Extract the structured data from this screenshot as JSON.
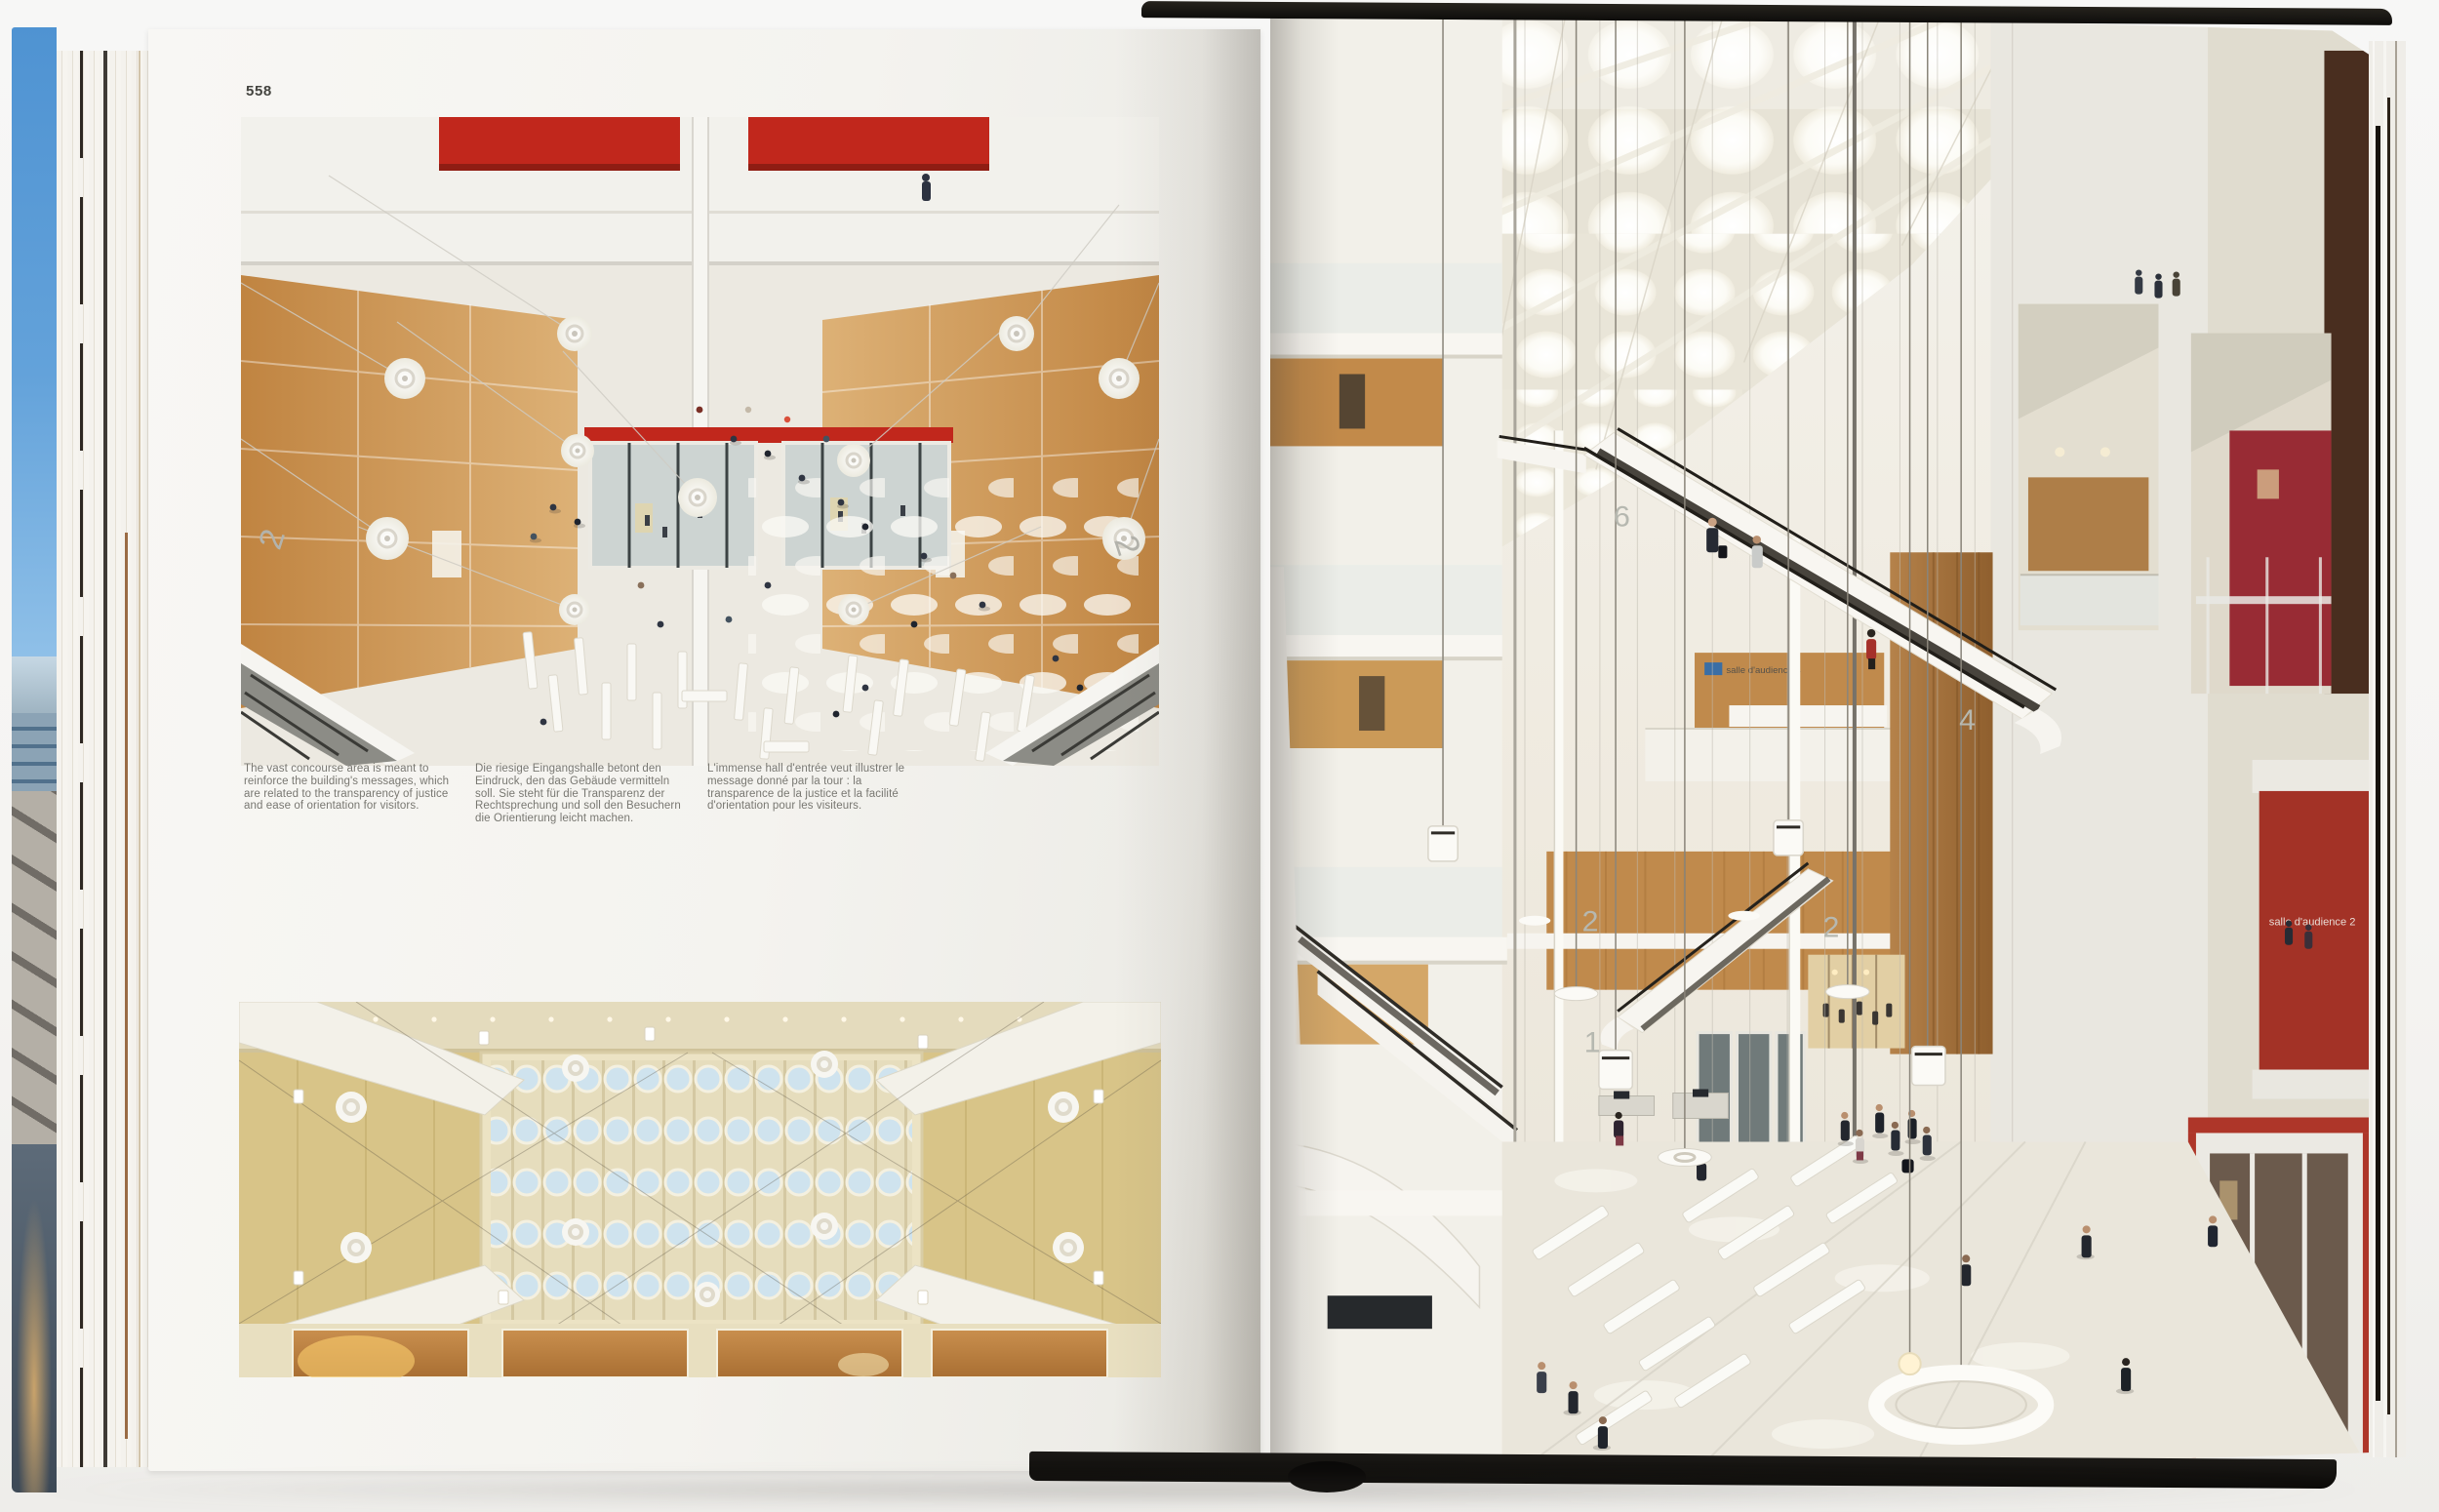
{
  "page_left": {
    "number": "558",
    "captions": {
      "english": "The vast concourse area is meant to reinforce the building's messages, which are related to the transparency of justice and ease of orientation for visitors.",
      "german": "Die riesige Eingangshalle betont den Eindruck, den das Gebäude vermitteln soll. Sie steht für die Transparenz der Rechtsprechung und soll den Besuchern die Orientierung leicht machen.",
      "french": "L'immense hall d'entrée veut illustrer le message donné par la tour : la transparence de la justice et la facilité d'orientation pour les visiteurs."
    },
    "photo_top": {
      "floor_label_left": "2",
      "floor_label_right": "2"
    }
  },
  "page_right": {
    "floor_labels": {
      "level6": "6",
      "level4": "4",
      "level2_left": "2",
      "level2_right": "2",
      "level1": "1"
    },
    "signs": {
      "courtroom4": "salle d'audience 4",
      "courtroom2": "salle d'audience 2"
    }
  },
  "colors": {
    "accent_red": "#c1271c",
    "courtroom_red": "#a93226",
    "upper_red": "#9e2b35",
    "wood": "#c08a4c",
    "gold_wall": "#d9c485",
    "skylight_blue": "#cfe3ee",
    "cover_black": "#141210"
  }
}
